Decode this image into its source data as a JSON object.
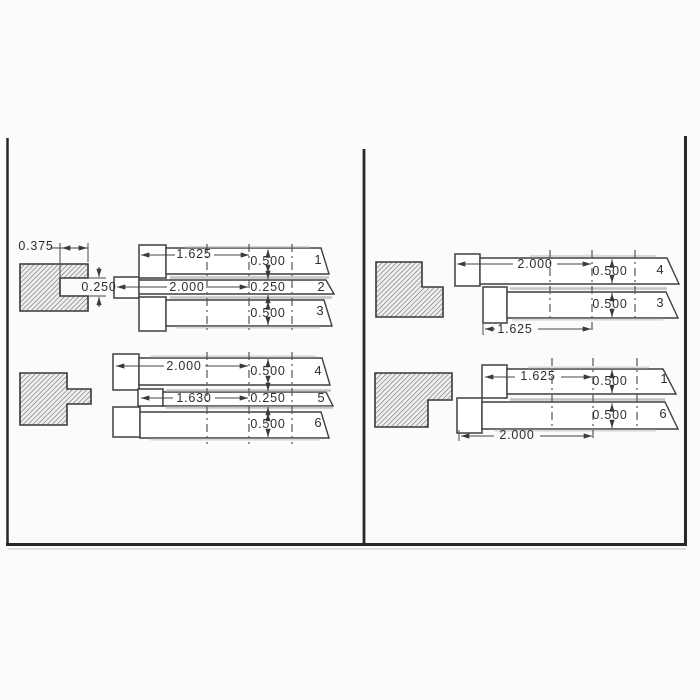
{
  "page": {
    "background": "#fbfbfa",
    "line_color": "#3f3f3f",
    "border_color": "#282828",
    "hatch_color": "#6e6e6e"
  },
  "left": {
    "top": {
      "block": {
        "slot_depth": "0.375",
        "slot_width": "0.250"
      },
      "strips": [
        {
          "num": "1",
          "length": "1.625",
          "width": "0.500"
        },
        {
          "num": "2",
          "length": "2.000",
          "width": "0.250"
        },
        {
          "num": "3",
          "width": "0.500"
        }
      ]
    },
    "bottom": {
      "strips": [
        {
          "num": "4",
          "length": "2.000",
          "width": "0.500"
        },
        {
          "num": "5",
          "length": "1.630",
          "width": "0.250"
        },
        {
          "num": "6",
          "width": "0.500"
        }
      ]
    }
  },
  "right": {
    "top": {
      "strips": [
        {
          "num": "4",
          "length": "2.000",
          "width": "0.500"
        },
        {
          "num": "3",
          "length": "1.625",
          "width": "0.500"
        }
      ]
    },
    "bottom": {
      "strips": [
        {
          "num": "1",
          "length": "1.625",
          "width": "0.500"
        },
        {
          "num": "6",
          "length": "2.000",
          "width": "0.500"
        }
      ]
    }
  }
}
